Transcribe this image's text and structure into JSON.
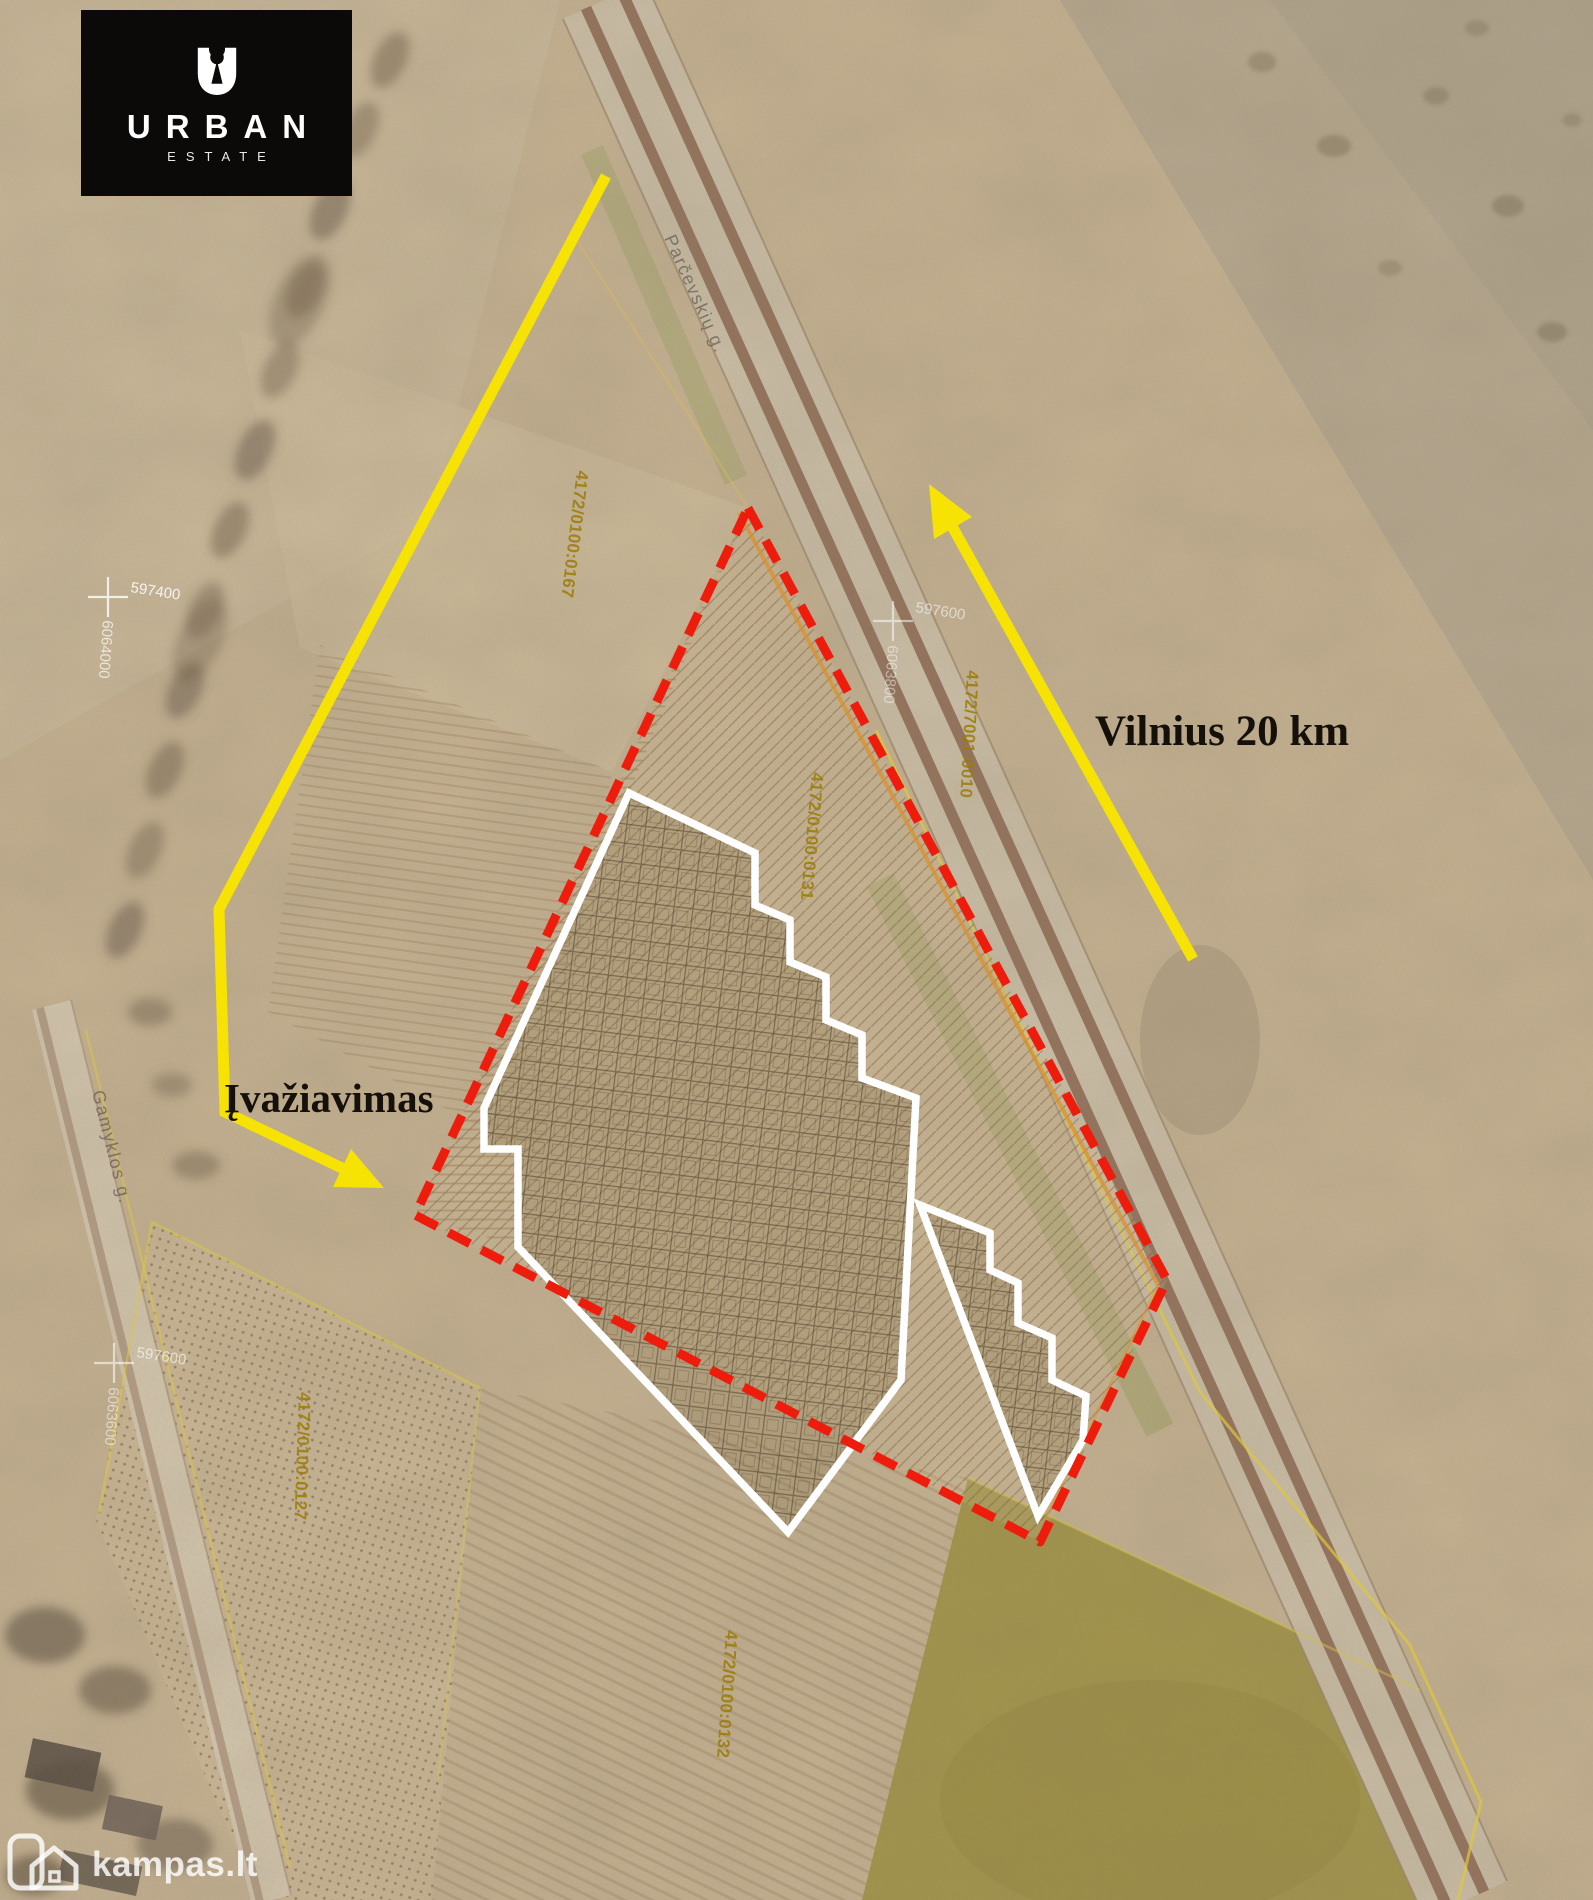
{
  "branding": {
    "name": "URBAN",
    "subtitle": "ESTATE"
  },
  "watermark": {
    "site": "kampas.lt"
  },
  "annotations": {
    "distance_label": "Vilnius 20 km",
    "entrance_label": "Įvažiavimas"
  },
  "streets": {
    "main_road": "Parčevskių g.",
    "side_road": "Gamyklos g."
  },
  "cadastral_parcels": [
    {
      "number": "4172/0100:0167"
    },
    {
      "number": "4172/7001:0010"
    },
    {
      "number": "4172/0100:0131"
    },
    {
      "number": "4172/0100:0127"
    },
    {
      "number": "4172/0100:0132"
    }
  ],
  "grid_markers": [
    {
      "easting": "597400",
      "northing": "6064000"
    },
    {
      "easting": "597600",
      "northing": "6063800"
    },
    {
      "easting": "597600",
      "northing": "6063600"
    }
  ],
  "colors": {
    "boundary_red": "#ee1c0c",
    "arrow_yellow": "#f6e303",
    "plot_outline_white": "#ffffff",
    "cadastral_text": "#9a7b08"
  }
}
